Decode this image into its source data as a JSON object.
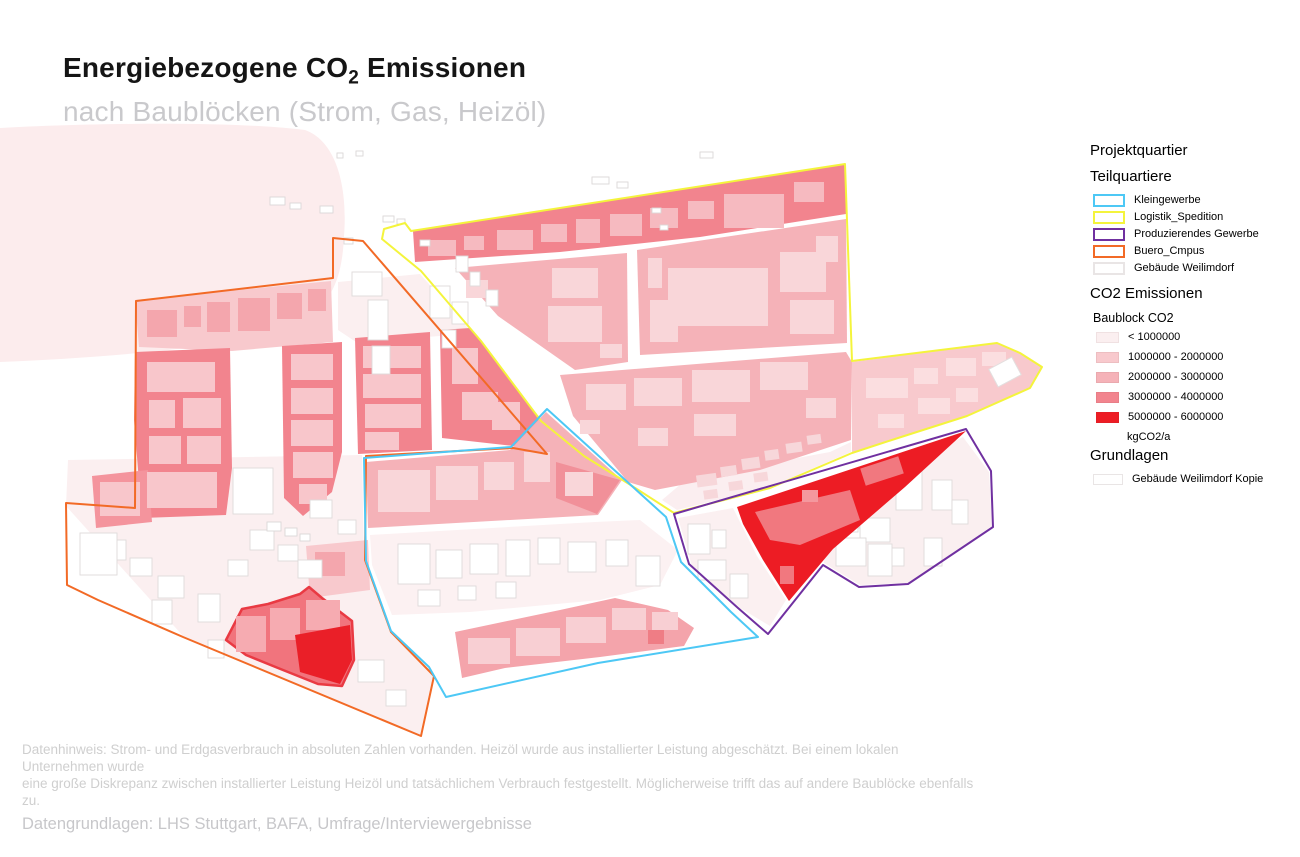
{
  "title": {
    "main_pre": "Energiebezogene CO",
    "main_sub": "2",
    "main_post": " Emissionen",
    "subtitle": "nach Baublöcken (Strom, Gas, Heizöl)"
  },
  "legend": {
    "project": "Projektquartier",
    "teilquartiere": {
      "title": "Teilquartiere",
      "items": [
        {
          "label": "Kleingewerbe",
          "color": "#4dc8f5"
        },
        {
          "label": "Logistik_Spedition",
          "color": "#f4f43c"
        },
        {
          "label": "Produzierendes Gewerbe",
          "color": "#7030a0"
        },
        {
          "label": "Buero_Cmpus",
          "color": "#f26a26"
        },
        {
          "label": "Gebäude Weilimdorf",
          "color": "#e9e5e5"
        }
      ]
    },
    "co2": {
      "title": "CO2 Emissionen",
      "layer": "Baublock CO2",
      "classes": [
        {
          "label": "< 1000000",
          "color": "#fbeff0"
        },
        {
          "label": "1000000 - 2000000",
          "color": "#f8c9cd"
        },
        {
          "label": "2000000 - 3000000",
          "color": "#f5b2b8"
        },
        {
          "label": "3000000 - 4000000",
          "color": "#f2848e"
        },
        {
          "label": "5000000 - 6000000",
          "color": "#ed1c24"
        }
      ],
      "unit": "kgCO2/a"
    },
    "grundlagen": {
      "title": "Grundlagen",
      "items": [
        {
          "label": "Gebäude Weilimdorf Kopie",
          "color": "#e9e5e5"
        }
      ]
    }
  },
  "footer": {
    "note_line1": "Datenhinweis: Strom- und Erdgasverbrauch in absoluten Zahlen vorhanden. Heizöl wurde aus installierter Leistung abgeschätzt. Bei einem lokalen Unternehmen wurde",
    "note_line2": "eine große Diskrepanz zwischen installierter Leistung Heizöl und tatsächlichem Verbrauch festgestellt. Möglicherweise trifft das auf andere Baublöcke ebenfalls zu.",
    "sources": "Datengrundlagen: LHS Stuttgart, BAFA, Umfrage/Interviewergebnisse"
  },
  "map_palette": {
    "background_blob": "#fceced",
    "block_pale": "#fbeff0",
    "block_light": "#f8c9cd",
    "block_medium": "#f5b2b8",
    "block_salmon": "#f2848e",
    "block_red": "#ed1c24",
    "building_on_salmon": "#f8c6cb",
    "building_on_medium": "#f9d6d9",
    "building_white_stroke": "#dedada",
    "red_block_border": "#e93a43"
  }
}
